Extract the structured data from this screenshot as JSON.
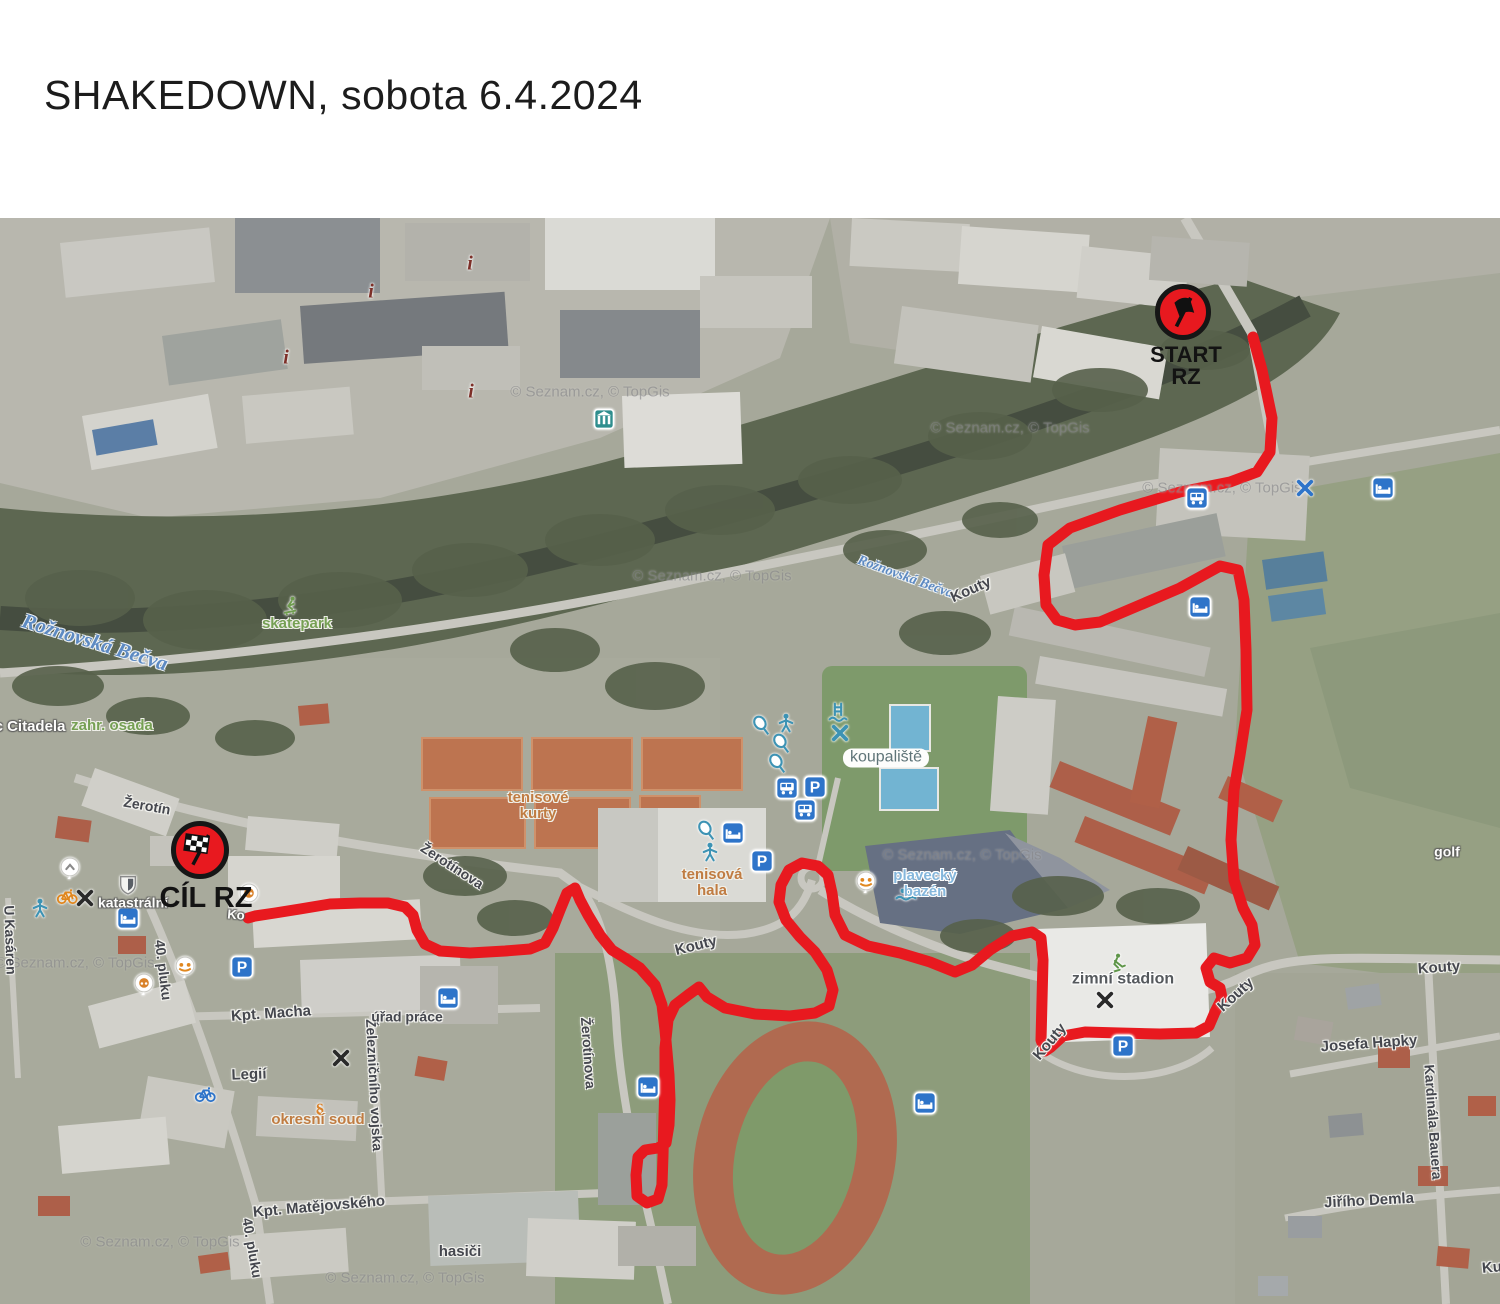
{
  "title": "SHAKEDOWN, sobota 6.4.2024",
  "map": {
    "attribution": "© Seznam.cz, © TopGis",
    "watermarks": [
      [
        590,
        174
      ],
      [
        1010,
        210
      ],
      [
        1222,
        270
      ],
      [
        712,
        358
      ],
      [
        962,
        637
      ],
      [
        75,
        745
      ],
      [
        160,
        1024
      ],
      [
        405,
        1060
      ]
    ],
    "route": {
      "color": "#e8191f",
      "width": 11,
      "points": [
        [
          1253,
          119
        ],
        [
          1262,
          152
        ],
        [
          1272,
          200
        ],
        [
          1270,
          234
        ],
        [
          1257,
          254
        ],
        [
          1230,
          264
        ],
        [
          1180,
          274
        ],
        [
          1120,
          292
        ],
        [
          1070,
          310
        ],
        [
          1048,
          327
        ],
        [
          1044,
          357
        ],
        [
          1046,
          387
        ],
        [
          1057,
          402
        ],
        [
          1075,
          407
        ],
        [
          1100,
          404
        ],
        [
          1140,
          387
        ],
        [
          1180,
          370
        ],
        [
          1220,
          348
        ],
        [
          1238,
          352
        ],
        [
          1244,
          382
        ],
        [
          1246,
          432
        ],
        [
          1247,
          492
        ],
        [
          1240,
          537
        ],
        [
          1234,
          572
        ],
        [
          1231,
          622
        ],
        [
          1234,
          662
        ],
        [
          1243,
          690
        ],
        [
          1252,
          707
        ],
        [
          1255,
          727
        ],
        [
          1247,
          740
        ],
        [
          1230,
          745
        ],
        [
          1214,
          740
        ],
        [
          1206,
          750
        ],
        [
          1210,
          764
        ],
        [
          1220,
          770
        ],
        [
          1222,
          780
        ],
        [
          1215,
          794
        ],
        [
          1209,
          808
        ],
        [
          1196,
          815
        ],
        [
          1160,
          816
        ],
        [
          1120,
          815
        ],
        [
          1085,
          814
        ],
        [
          1063,
          818
        ],
        [
          1051,
          829
        ],
        [
          1045,
          833
        ],
        [
          1041,
          822
        ],
        [
          1042,
          782
        ],
        [
          1043,
          742
        ],
        [
          1041,
          720
        ],
        [
          1032,
          714
        ],
        [
          1012,
          718
        ],
        [
          990,
          732
        ],
        [
          972,
          747
        ],
        [
          955,
          754
        ],
        [
          930,
          744
        ],
        [
          900,
          735
        ],
        [
          868,
          728
        ],
        [
          845,
          717
        ],
        [
          835,
          697
        ],
        [
          832,
          675
        ],
        [
          828,
          657
        ],
        [
          818,
          648
        ],
        [
          802,
          645
        ],
        [
          789,
          652
        ],
        [
          781,
          667
        ],
        [
          779,
          684
        ],
        [
          786,
          702
        ],
        [
          800,
          719
        ],
        [
          815,
          734
        ],
        [
          827,
          752
        ],
        [
          833,
          772
        ],
        [
          829,
          788
        ],
        [
          815,
          795
        ],
        [
          790,
          798
        ],
        [
          755,
          796
        ],
        [
          725,
          790
        ],
        [
          707,
          779
        ],
        [
          699,
          769
        ],
        [
          688,
          777
        ],
        [
          675,
          787
        ],
        [
          668,
          802
        ],
        [
          665,
          830
        ],
        [
          665,
          862
        ],
        [
          664,
          899
        ],
        [
          663,
          937
        ],
        [
          662,
          967
        ],
        [
          658,
          981
        ],
        [
          647,
          985
        ],
        [
          637,
          978
        ],
        [
          636,
          957
        ],
        [
          638,
          939
        ],
        [
          645,
          932
        ],
        [
          658,
          930
        ],
        [
          666,
          925
        ],
        [
          669,
          907
        ],
        [
          670,
          882
        ],
        [
          669,
          857
        ],
        [
          667,
          834
        ],
        [
          665,
          812
        ],
        [
          662,
          787
        ],
        [
          655,
          767
        ],
        [
          640,
          750
        ],
        [
          625,
          740
        ],
        [
          612,
          732
        ],
        [
          600,
          717
        ],
        [
          588,
          697
        ],
        [
          580,
          682
        ],
        [
          575,
          670
        ],
        [
          567,
          675
        ],
        [
          560,
          692
        ],
        [
          553,
          710
        ],
        [
          545,
          725
        ],
        [
          530,
          731
        ],
        [
          505,
          733
        ],
        [
          470,
          735
        ],
        [
          440,
          733
        ],
        [
          425,
          726
        ],
        [
          417,
          712
        ],
        [
          413,
          697
        ],
        [
          405,
          689
        ],
        [
          388,
          685
        ],
        [
          360,
          685
        ],
        [
          330,
          686
        ],
        [
          300,
          691
        ],
        [
          275,
          695
        ],
        [
          255,
          698
        ],
        [
          248,
          700
        ]
      ]
    },
    "markers": [
      {
        "type": "start",
        "flag": "black",
        "x": 1183,
        "y": 94,
        "d": 56,
        "lines": [
          "START",
          "RZ"
        ],
        "lx": 1186,
        "ly": 126,
        "lfs": 22
      },
      {
        "type": "finish",
        "flag": "checkered",
        "x": 200,
        "y": 632,
        "d": 58,
        "lines": [
          "CÍL RZ"
        ],
        "lx": 206,
        "ly": 666,
        "lfs": 29
      }
    ],
    "labels": [
      {
        "t": "Rožnovská Bečva",
        "x": 95,
        "y": 424,
        "r": 17,
        "s": "river",
        "fs": 21
      },
      {
        "t": "Rožnovská Bečva",
        "x": 905,
        "y": 360,
        "r": 20,
        "s": "river",
        "fs": 14
      },
      {
        "t": "skatepark",
        "x": 297,
        "y": 406,
        "r": 0,
        "s": "green",
        "fs": 15
      },
      {
        "t": "zahr. osada",
        "x": 112,
        "y": 508,
        "r": 0,
        "s": "green",
        "fs": 15
      },
      {
        "t": "c Citadela",
        "x": 30,
        "y": 509,
        "r": 0,
        "s": "white",
        "fs": 15
      },
      {
        "t": "golf",
        "x": 1447,
        "y": 634,
        "r": 0,
        "s": "white",
        "fs": 14
      },
      {
        "t": "katastrální",
        "x": 133,
        "y": 685,
        "r": 0,
        "s": "white",
        "fs": 14
      },
      {
        "t": "Ko",
        "x": 236,
        "y": 697,
        "r": 5,
        "s": "white",
        "fs": 13
      },
      {
        "t": "koupaliště",
        "x": 886,
        "y": 540,
        "r": 0,
        "s": "box",
        "fs": 16
      },
      {
        "t": "tenisové\nkurty",
        "x": 538,
        "y": 588,
        "r": 0,
        "s": "orange",
        "fs": 15
      },
      {
        "t": "tenisová\nhala",
        "x": 712,
        "y": 665,
        "r": 0,
        "s": "orange",
        "fs": 15
      },
      {
        "t": "okresní soud",
        "x": 318,
        "y": 902,
        "r": 0,
        "s": "orange",
        "fs": 15
      },
      {
        "t": "plavecký\nbazén",
        "x": 925,
        "y": 666,
        "r": 0,
        "s": "teal",
        "fs": 15
      },
      {
        "t": "zimní stadion",
        "x": 1123,
        "y": 762,
        "r": 0,
        "s": "dark",
        "fs": 16
      },
      {
        "t": "Žerotín",
        "x": 147,
        "y": 588,
        "r": 10,
        "s": "street",
        "fs": 14
      },
      {
        "t": "Žerotínova",
        "x": 452,
        "y": 648,
        "r": 33,
        "s": "street",
        "fs": 14
      },
      {
        "t": "Žerotínova",
        "x": 588,
        "y": 835,
        "r": 86,
        "s": "street",
        "fs": 14
      },
      {
        "t": "Kouty",
        "x": 696,
        "y": 728,
        "r": -14,
        "s": "street",
        "fs": 15
      },
      {
        "t": "Kouty",
        "x": 971,
        "y": 372,
        "r": -24,
        "s": "street",
        "fs": 15
      },
      {
        "t": "Kouty",
        "x": 1236,
        "y": 777,
        "r": -42,
        "s": "street",
        "fs": 15
      },
      {
        "t": "Kouty",
        "x": 1050,
        "y": 824,
        "r": -50,
        "s": "street",
        "fs": 15
      },
      {
        "t": "Kouty",
        "x": 1439,
        "y": 750,
        "r": -4,
        "s": "street",
        "fs": 15
      },
      {
        "t": "Ku",
        "x": 1492,
        "y": 1050,
        "r": -5,
        "s": "street",
        "fs": 15
      },
      {
        "t": "Kpt. Macha",
        "x": 271,
        "y": 796,
        "r": -4,
        "s": "street",
        "fs": 15
      },
      {
        "t": "Legií",
        "x": 249,
        "y": 857,
        "r": -2,
        "s": "street",
        "fs": 15
      },
      {
        "t": "Železničního vojska",
        "x": 374,
        "y": 867,
        "r": 87,
        "s": "street",
        "fs": 14
      },
      {
        "t": "úřad práce",
        "x": 407,
        "y": 799,
        "r": 0,
        "s": "street",
        "fs": 14
      },
      {
        "t": "Kpt. Matějovského",
        "x": 319,
        "y": 989,
        "r": -5,
        "s": "street",
        "fs": 15
      },
      {
        "t": "40. pluku",
        "x": 163,
        "y": 752,
        "r": 83,
        "s": "street",
        "fs": 14
      },
      {
        "t": "40. pluku",
        "x": 252,
        "y": 1030,
        "r": 80,
        "s": "street",
        "fs": 14
      },
      {
        "t": "hasiči",
        "x": 460,
        "y": 1034,
        "r": 0,
        "s": "street",
        "fs": 15
      },
      {
        "t": "Josefa Hapky",
        "x": 1369,
        "y": 826,
        "r": -4,
        "s": "street",
        "fs": 15
      },
      {
        "t": "Kardinála Bauera",
        "x": 1433,
        "y": 904,
        "r": 86,
        "s": "street",
        "fs": 14
      },
      {
        "t": "Jiřího Demla",
        "x": 1369,
        "y": 983,
        "r": -3,
        "s": "street",
        "fs": 15
      },
      {
        "t": "U Kasáren",
        "x": 10,
        "y": 722,
        "r": 88,
        "s": "street",
        "fs": 14
      }
    ],
    "icons": [
      {
        "n": "monument",
        "x": 470,
        "y": 45
      },
      {
        "n": "monument",
        "x": 371,
        "y": 73
      },
      {
        "n": "monument",
        "x": 286,
        "y": 139
      },
      {
        "n": "monument",
        "x": 471,
        "y": 173
      },
      {
        "n": "teal-building",
        "x": 604,
        "y": 201
      },
      {
        "n": "bus",
        "x": 1197,
        "y": 280
      },
      {
        "n": "x-blue",
        "x": 1305,
        "y": 270
      },
      {
        "n": "bed",
        "x": 1383,
        "y": 270
      },
      {
        "n": "bed",
        "x": 1200,
        "y": 389
      },
      {
        "n": "skater",
        "x": 290,
        "y": 388
      },
      {
        "n": "tennis",
        "x": 762,
        "y": 508
      },
      {
        "n": "person",
        "x": 786,
        "y": 505
      },
      {
        "n": "ladder",
        "x": 838,
        "y": 494
      },
      {
        "n": "x-teal",
        "x": 840,
        "y": 515
      },
      {
        "n": "tennis",
        "x": 782,
        "y": 526
      },
      {
        "n": "tennis",
        "x": 778,
        "y": 546
      },
      {
        "n": "bus",
        "x": 787,
        "y": 570
      },
      {
        "n": "parking",
        "x": 815,
        "y": 569
      },
      {
        "n": "bus",
        "x": 805,
        "y": 592
      },
      {
        "n": "tennis",
        "x": 707,
        "y": 613
      },
      {
        "n": "bed",
        "x": 733,
        "y": 615
      },
      {
        "n": "person",
        "x": 710,
        "y": 634
      },
      {
        "n": "parking",
        "x": 762,
        "y": 643
      },
      {
        "n": "playground",
        "x": 866,
        "y": 664
      },
      {
        "n": "swimmer",
        "x": 906,
        "y": 676
      },
      {
        "n": "white-pin",
        "x": 70,
        "y": 650
      },
      {
        "n": "bicycle-orange",
        "x": 67,
        "y": 677
      },
      {
        "n": "x-black",
        "x": 85,
        "y": 680
      },
      {
        "n": "person",
        "x": 40,
        "y": 690
      },
      {
        "n": "shield",
        "x": 128,
        "y": 666
      },
      {
        "n": "bed",
        "x": 128,
        "y": 700
      },
      {
        "n": "pretzel",
        "x": 249,
        "y": 676
      },
      {
        "n": "playground",
        "x": 185,
        "y": 749
      },
      {
        "n": "pretzel",
        "x": 144,
        "y": 766
      },
      {
        "n": "parking",
        "x": 242,
        "y": 749
      },
      {
        "n": "bed",
        "x": 448,
        "y": 780
      },
      {
        "n": "x-black",
        "x": 341,
        "y": 840
      },
      {
        "n": "bicycle-blue",
        "x": 205,
        "y": 875
      },
      {
        "n": "paragraph",
        "x": 320,
        "y": 892
      },
      {
        "n": "bed",
        "x": 648,
        "y": 869
      },
      {
        "n": "bed",
        "x": 925,
        "y": 885
      },
      {
        "n": "hockey",
        "x": 1117,
        "y": 745
      },
      {
        "n": "x-black",
        "x": 1105,
        "y": 782
      },
      {
        "n": "parking",
        "x": 1123,
        "y": 828
      }
    ]
  }
}
